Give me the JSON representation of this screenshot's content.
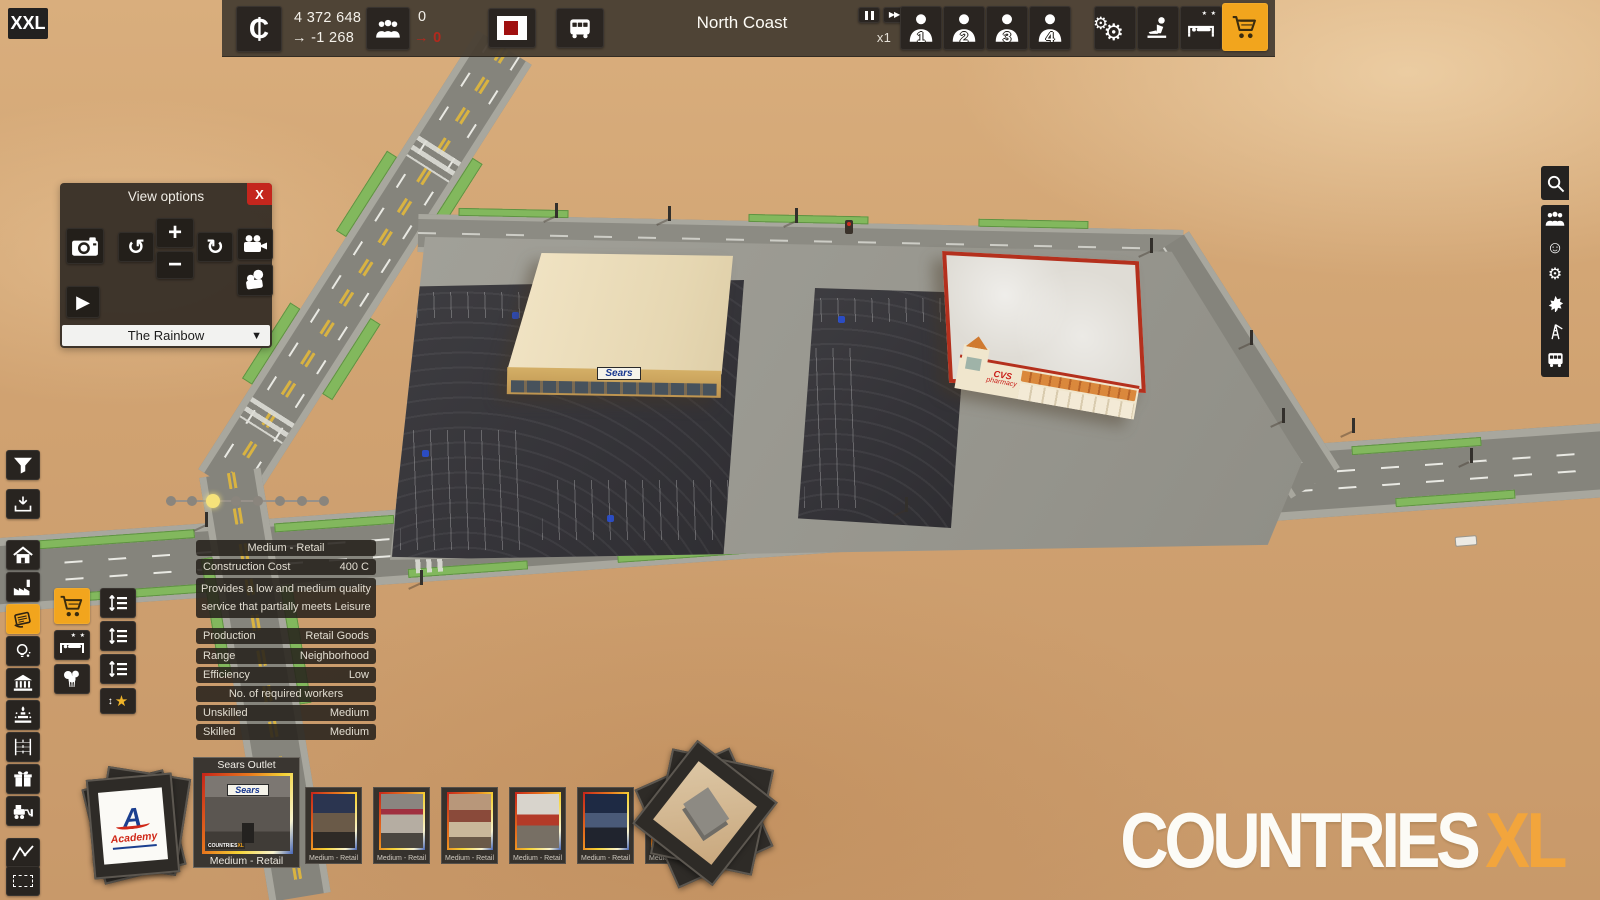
{
  "logo": {
    "text": "XXL"
  },
  "glyphs": {
    "play": "▶",
    "ff": "▶▶",
    "dropdown": "▼",
    "rotate_ccw": "↺",
    "rotate_cw": "↻",
    "gear": "⚙",
    "smiley": "☺",
    "star": "★",
    "arrow": "→",
    "hotel_stars": "★ ★",
    "close": "X"
  },
  "top_bar": {
    "money": {
      "currency_symbol": "₵",
      "balance": "4 372 648",
      "delta": "-1 268"
    },
    "population": {
      "count": "0",
      "delta": "0"
    },
    "city_name": "North Coast",
    "speed": "x1",
    "milestones": [
      {
        "num": "1"
      },
      {
        "num": "2"
      },
      {
        "num": "3"
      },
      {
        "num": "4"
      }
    ]
  },
  "view_options": {
    "title": "View options",
    "zoom_in": "+",
    "zoom_out": "−",
    "map_name": "The Rainbow"
  },
  "tooltip": {
    "title": "Medium - Retail",
    "cost_label": "Construction Cost",
    "cost_value": "400 C",
    "description_line1": "Provides a low and medium quality",
    "description_line2": "service that partially meets Leisure",
    "rows": [
      {
        "label": "Production",
        "value": "Retail Goods"
      },
      {
        "label": "Range",
        "value": "Neighborhood"
      },
      {
        "label": "Efficiency",
        "value": "Low"
      }
    ],
    "workers_header": "No. of required workers",
    "workers": [
      {
        "label": "Unskilled",
        "value": "Medium"
      },
      {
        "label": "Skilled",
        "value": "Medium"
      }
    ]
  },
  "palette": {
    "academy_brand": "Academy",
    "selected": {
      "title": "Sears Outlet",
      "brand": "Sears",
      "label": "Medium - Retail",
      "mini_watermark": "COUNTRIES",
      "mini_watermark_xl": "XL"
    },
    "thumbs": [
      {
        "label": "Medium - Retail"
      },
      {
        "label": "Medium - Retail"
      },
      {
        "label": "Medium - Retail"
      },
      {
        "label": "Medium - Retail"
      },
      {
        "label": "Medium - Retail"
      },
      {
        "label": "Medium - Retail"
      }
    ]
  },
  "scene": {
    "sears_sign": "Sears",
    "cvs_line1": "CVS",
    "cvs_line2": "pharmacy"
  },
  "watermark": {
    "text": "COUNTRIES",
    "xl": "XL"
  },
  "colors": {
    "accent_orange": "#f2a51d",
    "alert_red": "#b3291d",
    "select_yellow": "#f6e27a"
  }
}
